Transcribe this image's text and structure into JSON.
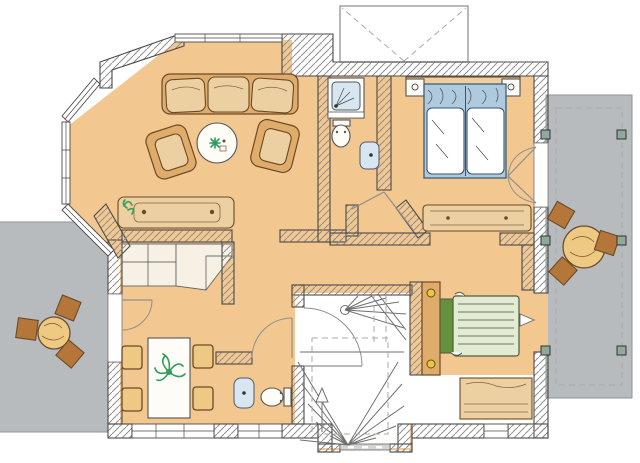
{
  "plan": {
    "kind": "architectural-floor-plan",
    "style": "hand-drawn-color-sketch",
    "visible_text": [],
    "rooms": [
      {
        "name": "living-room",
        "position": "top-left",
        "features": [
          "octagonal-bay-window"
        ],
        "furniture": [
          "three-seat-sofa",
          "armchair-left",
          "armchair-right",
          "round-coffee-table",
          "potted-plant",
          "sideboard-with-plant"
        ]
      },
      {
        "name": "bathroom-top",
        "position": "top-center",
        "fixtures": [
          "shower",
          "toilet",
          "wash-basin"
        ]
      },
      {
        "name": "bedroom-top-right",
        "position": "top-right",
        "furniture": [
          "double-bed-blue-bedding",
          "nightstand-left",
          "nightstand-right",
          "headboard-shelf",
          "long-dresser"
        ],
        "doors": [
          "french-double-door-to-terrace"
        ]
      },
      {
        "name": "dining-room",
        "position": "bottom-left",
        "furniture": [
          "rectangular-table-with-plant",
          "four-chairs",
          "corner-counter"
        ],
        "doors": [
          "door-to-left-terrace"
        ]
      },
      {
        "name": "wc",
        "position": "bottom-center-left",
        "fixtures": [
          "wash-basin",
          "toilet"
        ]
      },
      {
        "name": "stair-hall",
        "position": "bottom-center",
        "features": [
          "winder-staircase",
          "up-arrow",
          "entrance-porch"
        ]
      },
      {
        "name": "bedroom-bottom-right",
        "position": "bottom-right",
        "furniture": [
          "single-bed-green-bedding",
          "wardrobe-strip",
          "dresser",
          "wall-lamp"
        ],
        "doors": [
          "opening-to-right-terrace"
        ]
      }
    ],
    "outdoor": [
      {
        "name": "left-terrace",
        "furniture": [
          "round-table",
          "chair",
          "chair",
          "chair"
        ]
      },
      {
        "name": "right-terrace",
        "furniture": [
          "round-table",
          "chair",
          "chair",
          "chair"
        ],
        "features": [
          "dashed-border",
          "six-posts"
        ]
      },
      {
        "name": "roof-dormer",
        "position": "top",
        "features": [
          "dashed-valley-lines"
        ]
      }
    ]
  },
  "colors": {
    "floor": "#f2c790",
    "terrace": "#b7bbbe",
    "terraceEdge": "#8f9497",
    "wallStroke": "#4a4a4a",
    "hatch": "#8f8f8f",
    "tan": "#e0ac6b",
    "tanLight": "#ecd0a1",
    "brown": "#b5763a",
    "furnStroke": "#6b4a26",
    "cream": "#f6f1e4",
    "fixtureBlue": "#d7e6f0",
    "bedBlue": "#aecadf",
    "bedGreenLight": "#e1ecd3",
    "bedGreenDark": "#66913d",
    "plantGreen": "#2f9e5f",
    "tableYellow": "#eec983",
    "postGreen": "#8fa99a",
    "doorArc": "#8f8f8f",
    "stair": "#6f6f6f",
    "dash": "#aaaaaa"
  }
}
